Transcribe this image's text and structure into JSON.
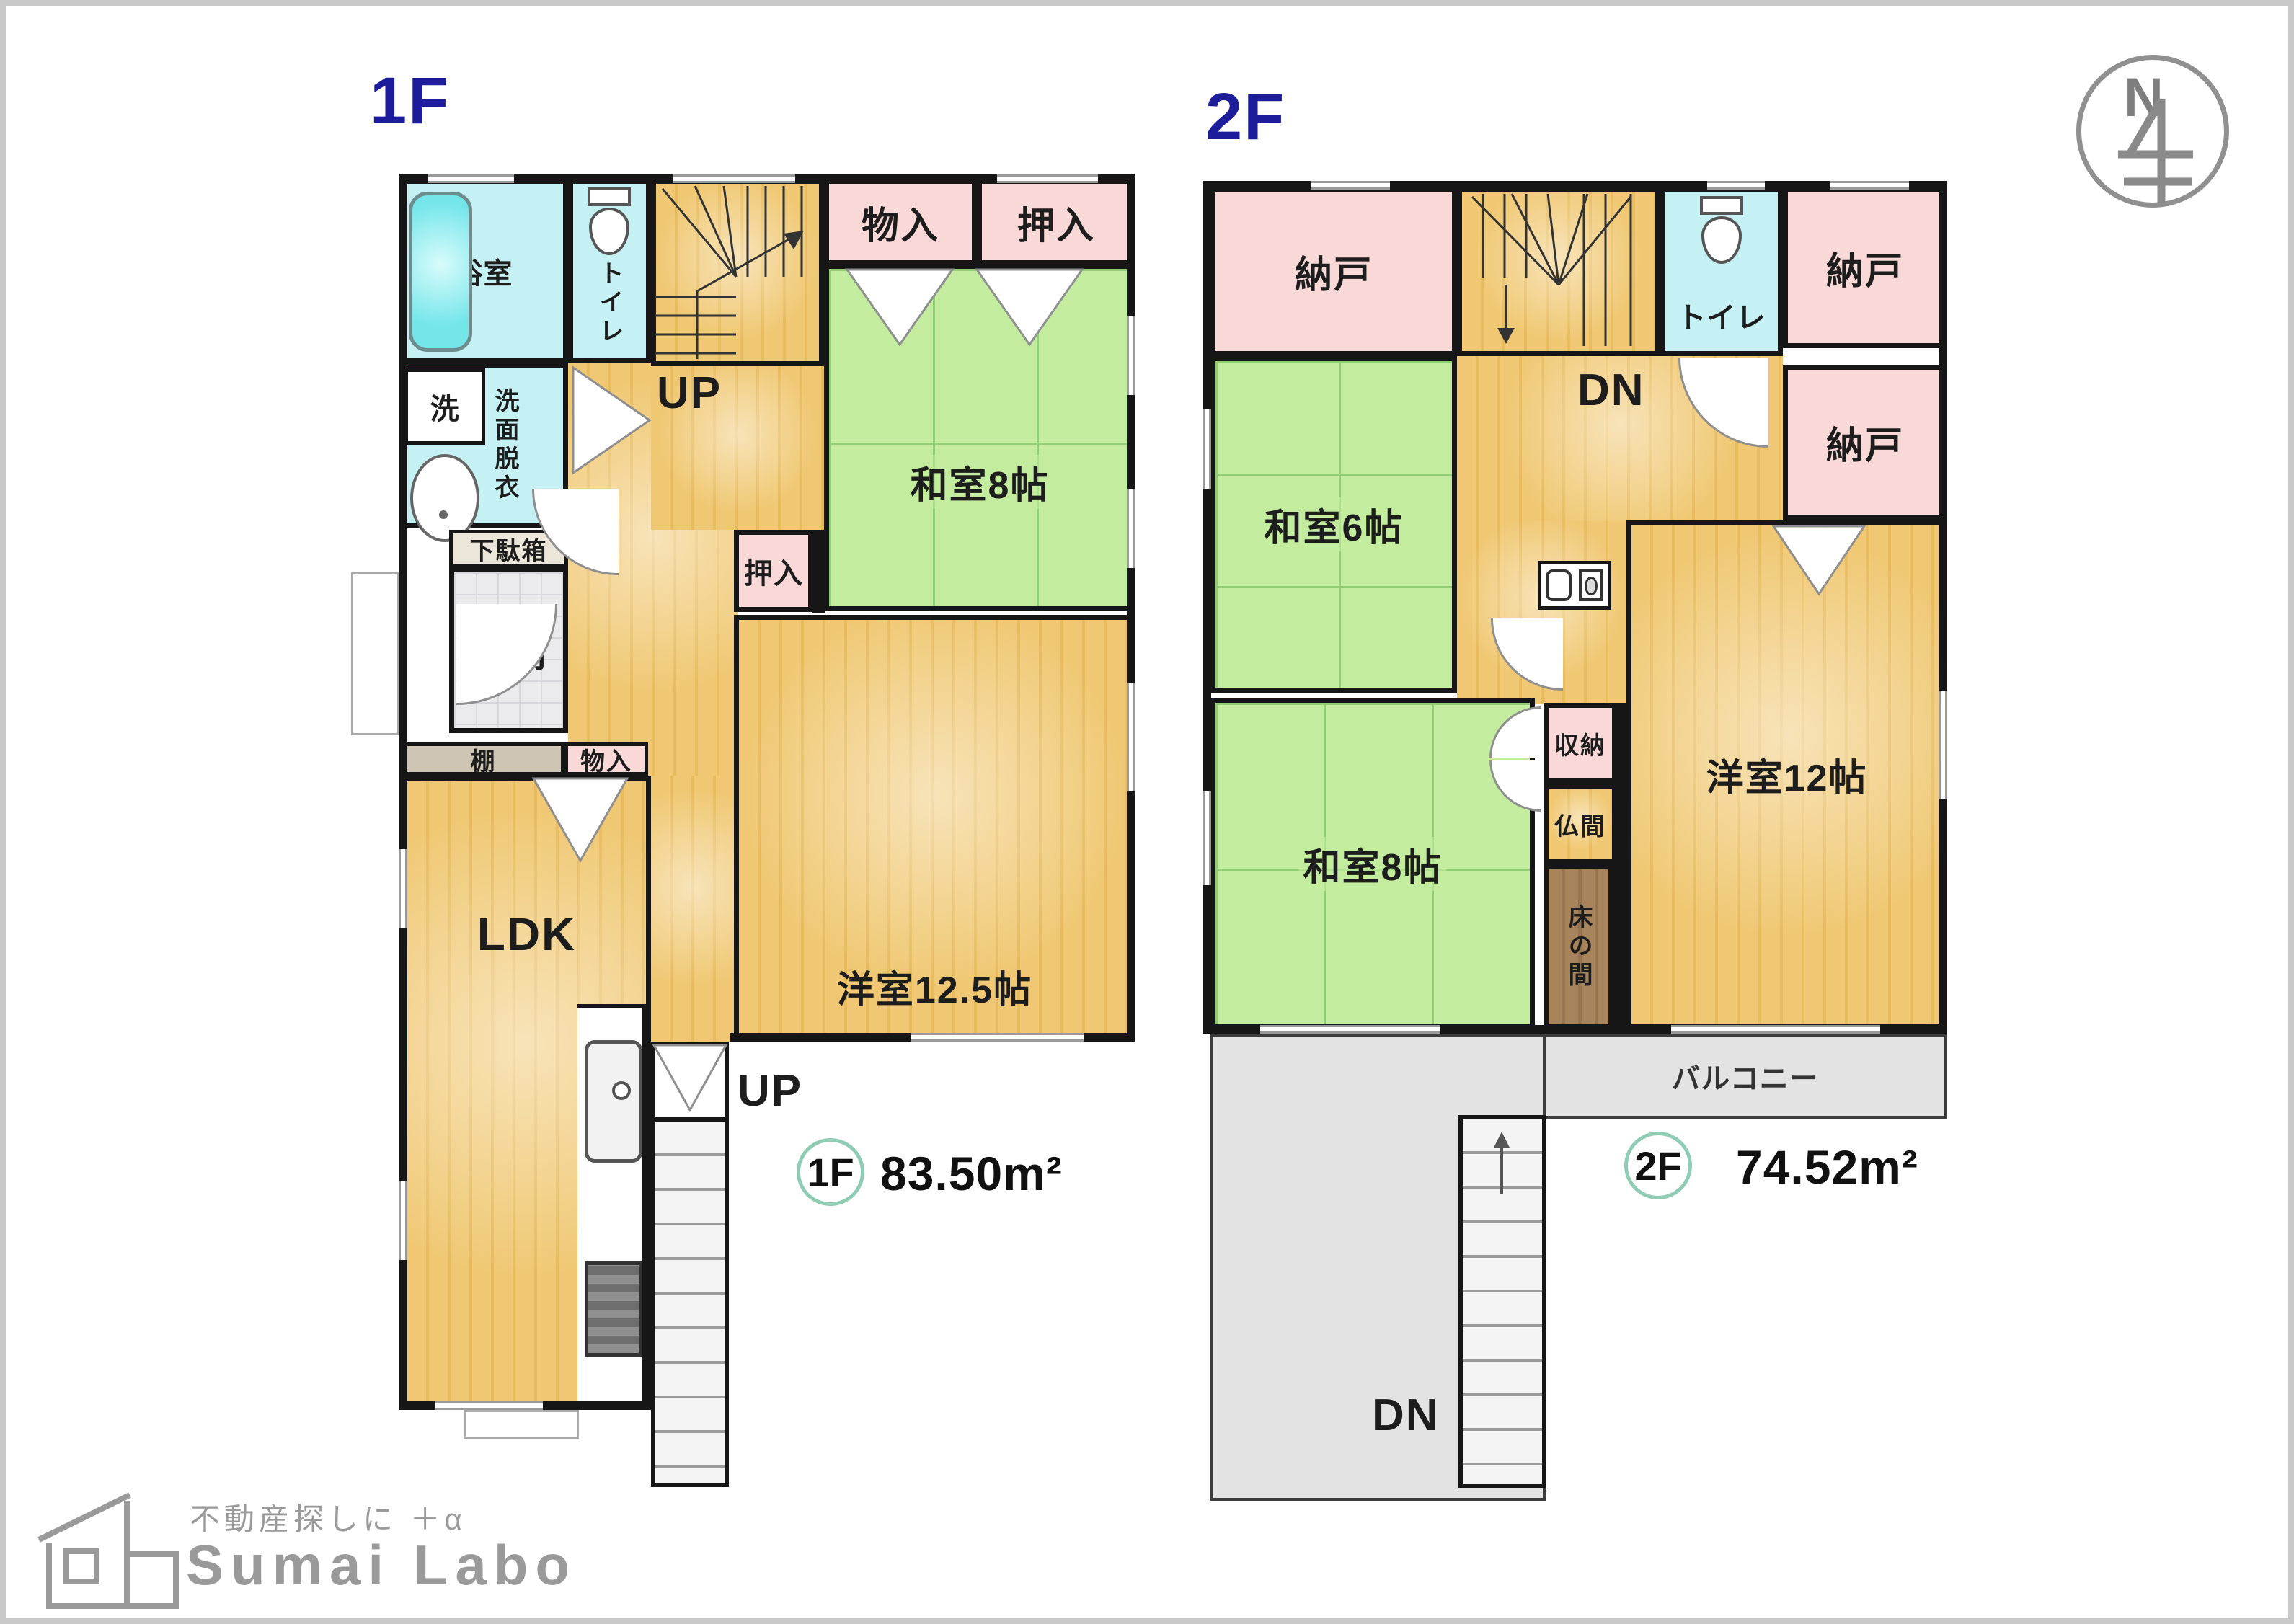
{
  "north": {
    "label": "N"
  },
  "logo": {
    "tagline": "不動産探しに ＋α",
    "name": "Sumai Labo"
  },
  "floor1": {
    "title": "1F",
    "badge": "1F",
    "area": "83.50m²",
    "rooms": {
      "bath": "浴室",
      "toilet": "トイレ",
      "stairs_up": "UP",
      "storage_top": "物入",
      "closet_top": "押入",
      "washitsu8": "和室8帖",
      "laundry": "洗",
      "senmen": "洗面脱衣",
      "shoe_cabinet": "下駄箱",
      "genkan": "玄関",
      "closet_hall": "押入",
      "yoshitsu": "洋室12.5帖",
      "shelf": "棚",
      "storage_ldk": "物入",
      "ldk": "LDK",
      "ext_stairs_up": "UP"
    }
  },
  "floor2": {
    "title": "2F",
    "badge": "2F",
    "area": "74.52m²",
    "rooms": {
      "nando_tl": "納戸",
      "stairs_dn": "DN",
      "toilet": "トイレ",
      "nando_tr": "納戸",
      "nando_r": "納戸",
      "washitsu6": "和室6帖",
      "washitsu8": "和室8帖",
      "shuno": "収納",
      "butsuma": "仏間",
      "tokonoma": "床の間",
      "yoshitsu12": "洋室12帖",
      "balcony": "バルコニー",
      "ext_stairs_dn": "DN"
    }
  }
}
